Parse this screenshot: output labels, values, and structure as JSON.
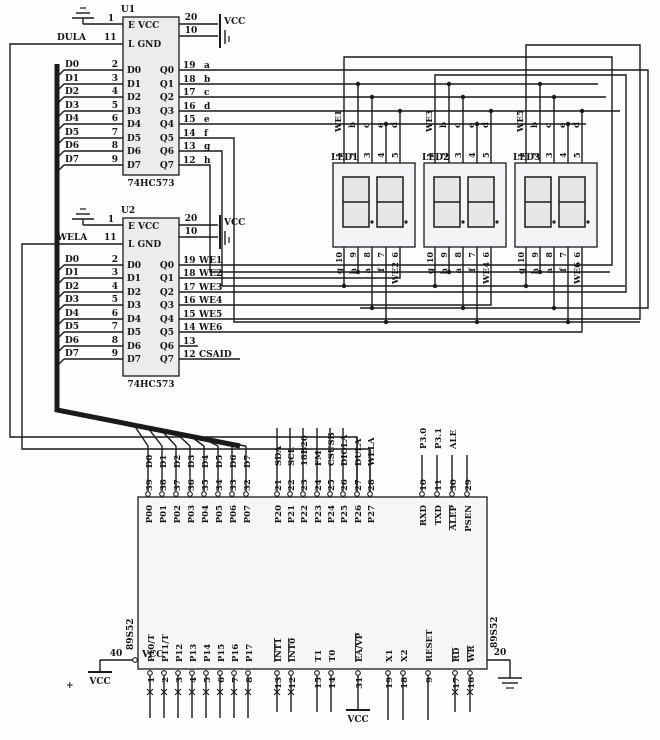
{
  "colors": {
    "wire": "#1a1a1a",
    "background": "#fdfdfd",
    "chip_fill": "#ececec",
    "display_fill": "#f4f4f6",
    "digit_fill": "#e7e7e7",
    "mcu_fill": "#f6f6f6",
    "text": "#151515"
  },
  "u1": {
    "ref": "U1",
    "part": "74HC573",
    "ctrl": {
      "oe_pin": "1",
      "le_net": "DULA",
      "le_pin": "11"
    },
    "power": {
      "vcc_pin": "20",
      "gnd_pin": "10",
      "vcc_label": "VCC"
    },
    "inner": {
      "row1": "E VCC",
      "row2": "L GND",
      "d": [
        "D0",
        "D1",
        "D2",
        "D3",
        "D4",
        "D5",
        "D6",
        "D7"
      ],
      "q": [
        "Q0",
        "Q1",
        "Q2",
        "Q3",
        "Q4",
        "Q5",
        "Q6",
        "Q7"
      ]
    },
    "inputs": [
      {
        "net": "D0",
        "pin": "2"
      },
      {
        "net": "D1",
        "pin": "3"
      },
      {
        "net": "D2",
        "pin": "4"
      },
      {
        "net": "D3",
        "pin": "5"
      },
      {
        "net": "D4",
        "pin": "6"
      },
      {
        "net": "D5",
        "pin": "7"
      },
      {
        "net": "D6",
        "pin": "8"
      },
      {
        "net": "D7",
        "pin": "9"
      }
    ],
    "outputs": [
      {
        "pin": "19",
        "net": "a"
      },
      {
        "pin": "18",
        "net": "b"
      },
      {
        "pin": "17",
        "net": "c"
      },
      {
        "pin": "16",
        "net": "d"
      },
      {
        "pin": "15",
        "net": "e"
      },
      {
        "pin": "14",
        "net": "f"
      },
      {
        "pin": "13",
        "net": "g"
      },
      {
        "pin": "12",
        "net": "h"
      }
    ]
  },
  "u2": {
    "ref": "U2",
    "part": "74HC573",
    "ctrl": {
      "oe_pin": "1",
      "le_net": "WELA",
      "le_pin": "11"
    },
    "power": {
      "vcc_pin": "20",
      "gnd_pin": "10",
      "vcc_label": "VCC"
    },
    "inner": {
      "row1": "E VCC",
      "row2": "L GND",
      "d": [
        "D0",
        "D1",
        "D2",
        "D3",
        "D4",
        "D5",
        "D6",
        "D7"
      ],
      "q": [
        "Q0",
        "Q1",
        "Q2",
        "Q3",
        "Q4",
        "Q5",
        "Q6",
        "Q7"
      ]
    },
    "inputs": [
      {
        "net": "D0",
        "pin": "2"
      },
      {
        "net": "D1",
        "pin": "3"
      },
      {
        "net": "D2",
        "pin": "4"
      },
      {
        "net": "D3",
        "pin": "5"
      },
      {
        "net": "D4",
        "pin": "6"
      },
      {
        "net": "D5",
        "pin": "7"
      },
      {
        "net": "D6",
        "pin": "8"
      },
      {
        "net": "D7",
        "pin": "9"
      }
    ],
    "outputs": [
      {
        "pin": "19",
        "net": "WE1"
      },
      {
        "pin": "18",
        "net": "WE2"
      },
      {
        "pin": "17",
        "net": "WE3"
      },
      {
        "pin": "16",
        "net": "WE4"
      },
      {
        "pin": "15",
        "net": "WE5"
      },
      {
        "pin": "14",
        "net": "WE6"
      },
      {
        "pin": "13",
        "net": ""
      },
      {
        "pin": "12",
        "net": "CSAID"
      }
    ]
  },
  "displays": [
    {
      "ref": "LED1",
      "top_pins": [
        "1",
        "2",
        "3",
        "4",
        "5"
      ],
      "top_nets": [
        "WE1",
        "b",
        "c",
        "e",
        "d"
      ],
      "bottom_pins": [
        "10",
        "9",
        "8",
        "7",
        "6"
      ],
      "bottom_nets": [
        "g",
        "h",
        "a",
        "f",
        "WE2"
      ]
    },
    {
      "ref": "LED2",
      "top_pins": [
        "1",
        "2",
        "3",
        "4",
        "5"
      ],
      "top_nets": [
        "WE3",
        "b",
        "c",
        "e",
        "d"
      ],
      "bottom_pins": [
        "10",
        "9",
        "8",
        "7",
        "6"
      ],
      "bottom_nets": [
        "g",
        "h",
        "a",
        "f",
        "WE4"
      ]
    },
    {
      "ref": "LED3",
      "top_pins": [
        "1",
        "2",
        "3",
        "4",
        "5"
      ],
      "top_nets": [
        "WE5",
        "b",
        "c",
        "e",
        "d"
      ],
      "bottom_pins": [
        "10",
        "9",
        "8",
        "7",
        "6"
      ],
      "bottom_nets": [
        "g",
        "h",
        "a",
        "f",
        "WE6"
      ]
    }
  ],
  "mcu": {
    "part": "89S52",
    "top_left": [
      {
        "name": "P00",
        "pin": "39",
        "net": "D0"
      },
      {
        "name": "P01",
        "pin": "38",
        "net": "D1"
      },
      {
        "name": "P02",
        "pin": "37",
        "net": "D2"
      },
      {
        "name": "P03",
        "pin": "36",
        "net": "D3"
      },
      {
        "name": "P04",
        "pin": "35",
        "net": "D4"
      },
      {
        "name": "P05",
        "pin": "34",
        "net": "D5"
      },
      {
        "name": "P06",
        "pin": "33",
        "net": "D6"
      },
      {
        "name": "P07",
        "pin": "32",
        "net": "D7"
      }
    ],
    "top_mid": [
      {
        "name": "P20",
        "pin": "21",
        "net": "SDA"
      },
      {
        "name": "P21",
        "pin": "22",
        "net": "SCL"
      },
      {
        "name": "P22",
        "pin": "23",
        "net": "18B20"
      },
      {
        "name": "P23",
        "pin": "24",
        "net": "FM"
      },
      {
        "name": "P24",
        "pin": "25",
        "net": "CSUSB"
      },
      {
        "name": "P25",
        "pin": "26",
        "net": "DIOLA"
      },
      {
        "name": "P26",
        "pin": "27",
        "net": "DULA"
      },
      {
        "name": "P27",
        "pin": "28",
        "net": "WELA"
      }
    ],
    "top_right": [
      {
        "name": "RXD",
        "pin": "10",
        "net": "P3.0"
      },
      {
        "name": "TXD",
        "pin": "11",
        "net": "P3.1"
      },
      {
        "name": "ALEP",
        "pin": "30",
        "net": "ALE"
      },
      {
        "name": "PSEN",
        "pin": "29",
        "net": ""
      }
    ],
    "left": {
      "label": "VCC",
      "pin": "40",
      "plus": "+",
      "power": "VCC"
    },
    "right": {
      "pin": "20"
    },
    "bottom": [
      {
        "name": "P10/T",
        "pin": "1"
      },
      {
        "name": "P11/T",
        "pin": "2"
      },
      {
        "name": "P12",
        "pin": "3"
      },
      {
        "name": "P13",
        "pin": "4"
      },
      {
        "name": "P14",
        "pin": "5"
      },
      {
        "name": "P15",
        "pin": "6"
      },
      {
        "name": "P16",
        "pin": "7"
      },
      {
        "name": "P17",
        "pin": "8"
      },
      {
        "name": "INT1",
        "pin": "13",
        "bar": true
      },
      {
        "name": "INT0",
        "pin": "12",
        "bar": true
      },
      {
        "name": "T1",
        "pin": "15"
      },
      {
        "name": "T0",
        "pin": "14"
      },
      {
        "name": "EA/VP",
        "pin": "31",
        "bar": true,
        "power": "VCC"
      },
      {
        "name": "X1",
        "pin": "19"
      },
      {
        "name": "X2",
        "pin": "18"
      },
      {
        "name": "RESET",
        "pin": "9"
      },
      {
        "name": "RD",
        "pin": "17",
        "bar": true
      },
      {
        "name": "WR",
        "pin": "16",
        "bar": true
      }
    ]
  }
}
